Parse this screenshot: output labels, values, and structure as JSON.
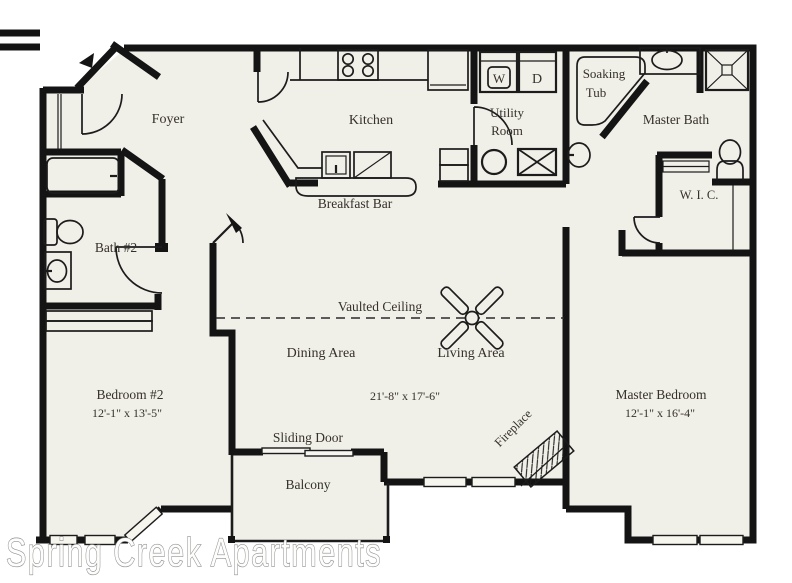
{
  "watermark": "Spring Creek Apartments",
  "colors": {
    "floor": "#f0efe8",
    "wall": "#141414",
    "label": "#35302a",
    "watermark_fill": "#fdfdfc",
    "watermark_stroke": "#8e8e8e",
    "background": "#ffffff"
  },
  "rooms": {
    "foyer": {
      "label": "Foyer"
    },
    "kitchen": {
      "label": "Kitchen"
    },
    "breakfast_bar": {
      "label": "Breakfast Bar"
    },
    "utility_room": {
      "label_line1": "Utility",
      "label_line2": "Room"
    },
    "soaking_tub": {
      "label_line1": "Soaking",
      "label_line2": "Tub"
    },
    "master_bath": {
      "label": "Master Bath"
    },
    "wic": {
      "label": "W. I. C."
    },
    "bath2": {
      "label": "Bath #2"
    },
    "vaulted_ceiling": {
      "label": "Vaulted Ceiling"
    },
    "dining": {
      "label": "Dining Area"
    },
    "living": {
      "label": "Living Area",
      "dims": "21'-8\" x 17'-6\""
    },
    "bedroom2": {
      "label": "Bedroom #2",
      "dims": "12'-1\" x 13'-5\""
    },
    "master_bedroom": {
      "label": "Master Bedroom",
      "dims": "12'-1\" x 16'-4\""
    },
    "sliding_door": {
      "label": "Sliding Door"
    },
    "balcony": {
      "label": "Balcony"
    },
    "fireplace": {
      "label": "Fireplace"
    }
  },
  "appliances": {
    "washer": "W",
    "dryer": "D"
  }
}
